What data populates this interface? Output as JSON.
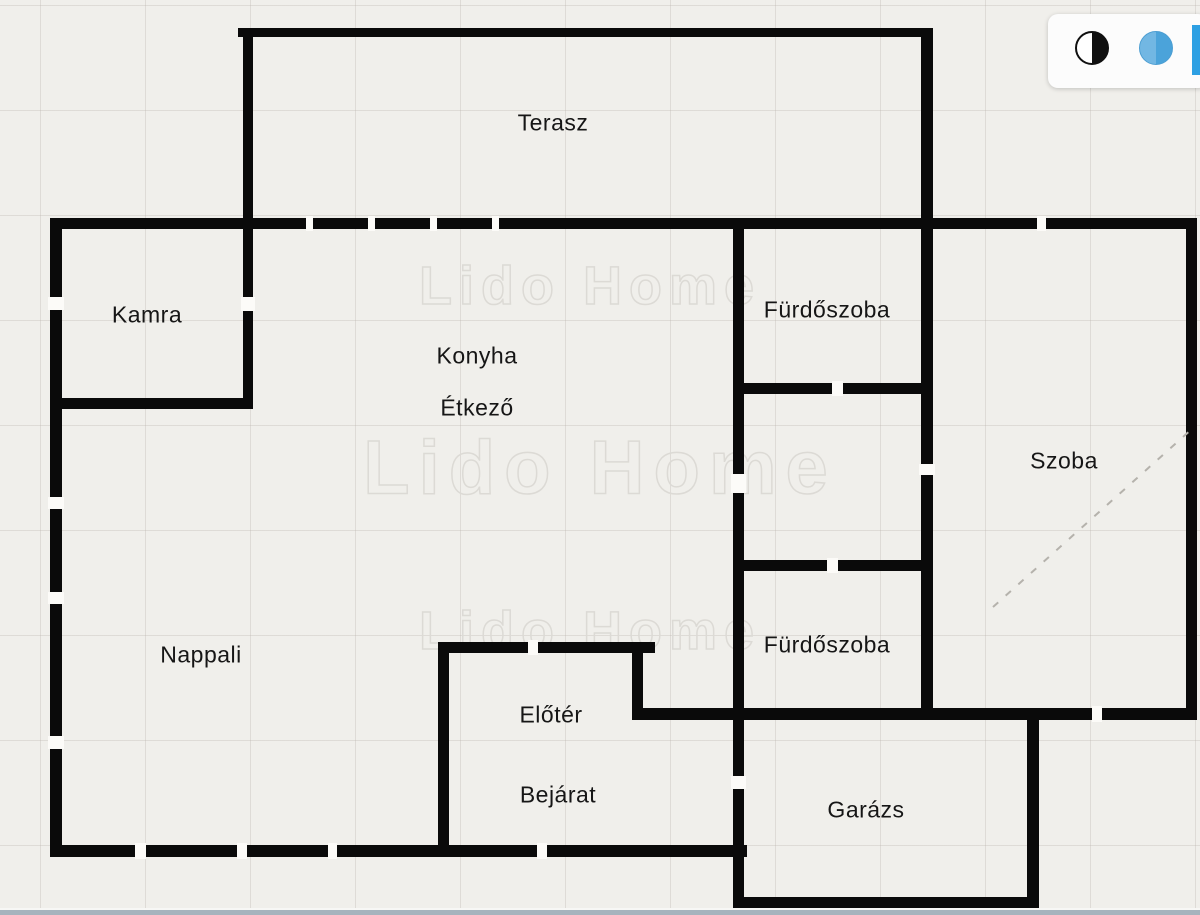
{
  "canvas": {
    "width": 1200,
    "height": 915,
    "background": "#f0efeb",
    "grid_color": "rgba(185,180,172,0.33)",
    "grid_size": 105
  },
  "watermark": {
    "text": "Lido Home",
    "outline_color": "#dcdad5",
    "instances": [
      {
        "x": 590,
        "y": 286,
        "font_size": 54,
        "letter_spacing": 7
      },
      {
        "x": 600,
        "y": 468,
        "font_size": 76,
        "letter_spacing": 9
      },
      {
        "x": 590,
        "y": 631,
        "font_size": 54,
        "letter_spacing": 7
      }
    ]
  },
  "floorplan": {
    "wall_color": "#0a0a0a",
    "opening_color": "#fcfbf8",
    "label_color": "#161616",
    "label_font_size": 23,
    "rooms": [
      {
        "id": "terasz",
        "label": "Terasz",
        "x": 553,
        "y": 123
      },
      {
        "id": "kamra",
        "label": "Kamra",
        "x": 147,
        "y": 315
      },
      {
        "id": "konyha",
        "label": "Konyha",
        "x": 477,
        "y": 356
      },
      {
        "id": "etkezo",
        "label": "Étkező",
        "x": 477,
        "y": 408
      },
      {
        "id": "furdoszoba-1",
        "label": "Fürdőszoba",
        "x": 827,
        "y": 310
      },
      {
        "id": "szoba",
        "label": "Szoba",
        "x": 1064,
        "y": 461
      },
      {
        "id": "nappali",
        "label": "Nappali",
        "x": 201,
        "y": 655
      },
      {
        "id": "furdoszoba-2",
        "label": "Fürdőszoba",
        "x": 827,
        "y": 645
      },
      {
        "id": "eloter",
        "label": "Előtér",
        "x": 551,
        "y": 715
      },
      {
        "id": "bejarat",
        "label": "Bejárat",
        "x": 558,
        "y": 795
      },
      {
        "id": "garazs",
        "label": "Garázs",
        "x": 866,
        "y": 810
      }
    ],
    "walls": [
      {
        "x": 50,
        "y": 218,
        "w": 12,
        "h": 639
      },
      {
        "x": 50,
        "y": 218,
        "w": 1147,
        "h": 11
      },
      {
        "x": 1186,
        "y": 218,
        "w": 11,
        "h": 502
      },
      {
        "x": 50,
        "y": 845,
        "w": 697,
        "h": 12
      },
      {
        "x": 632,
        "y": 708,
        "w": 565,
        "h": 12
      },
      {
        "x": 238,
        "y": 28,
        "w": 692,
        "h": 9
      },
      {
        "x": 243,
        "y": 28,
        "w": 10,
        "h": 380
      },
      {
        "x": 921,
        "y": 28,
        "w": 12,
        "h": 692
      },
      {
        "x": 50,
        "y": 398,
        "w": 203,
        "h": 11
      },
      {
        "x": 733,
        "y": 218,
        "w": 11,
        "h": 690
      },
      {
        "x": 733,
        "y": 383,
        "w": 200,
        "h": 11
      },
      {
        "x": 733,
        "y": 560,
        "w": 200,
        "h": 11
      },
      {
        "x": 438,
        "y": 642,
        "w": 11,
        "h": 215
      },
      {
        "x": 438,
        "y": 642,
        "w": 217,
        "h": 11
      },
      {
        "x": 632,
        "y": 642,
        "w": 11,
        "h": 78
      },
      {
        "x": 1027,
        "y": 708,
        "w": 12,
        "h": 200
      },
      {
        "x": 733,
        "y": 897,
        "w": 306,
        "h": 11
      }
    ],
    "openings": [
      {
        "x": 48,
        "y": 297,
        "w": 16,
        "h": 13
      },
      {
        "x": 48,
        "y": 497,
        "w": 16,
        "h": 12
      },
      {
        "x": 48,
        "y": 592,
        "w": 16,
        "h": 12
      },
      {
        "x": 48,
        "y": 736,
        "w": 16,
        "h": 13
      },
      {
        "x": 241,
        "y": 297,
        "w": 14,
        "h": 14
      },
      {
        "x": 306,
        "y": 216,
        "w": 7,
        "h": 15
      },
      {
        "x": 368,
        "y": 216,
        "w": 7,
        "h": 15
      },
      {
        "x": 430,
        "y": 216,
        "w": 7,
        "h": 15
      },
      {
        "x": 492,
        "y": 216,
        "w": 7,
        "h": 15
      },
      {
        "x": 1037,
        "y": 216,
        "w": 9,
        "h": 15
      },
      {
        "x": 919,
        "y": 464,
        "w": 16,
        "h": 11
      },
      {
        "x": 731,
        "y": 474,
        "w": 15,
        "h": 19
      },
      {
        "x": 731,
        "y": 776,
        "w": 15,
        "h": 13
      },
      {
        "x": 832,
        "y": 381,
        "w": 11,
        "h": 15
      },
      {
        "x": 827,
        "y": 558,
        "w": 11,
        "h": 15
      },
      {
        "x": 528,
        "y": 640,
        "w": 10,
        "h": 15
      },
      {
        "x": 135,
        "y": 843,
        "w": 11,
        "h": 16
      },
      {
        "x": 237,
        "y": 843,
        "w": 10,
        "h": 16
      },
      {
        "x": 328,
        "y": 843,
        "w": 9,
        "h": 16
      },
      {
        "x": 537,
        "y": 843,
        "w": 10,
        "h": 16
      },
      {
        "x": 1092,
        "y": 706,
        "w": 10,
        "h": 16
      }
    ],
    "dashed_line": {
      "x1": 993,
      "y1": 607,
      "x2": 1193,
      "y2": 428,
      "color": "#b5b2ac"
    }
  },
  "toolbar": {
    "background": "#fcfcfc",
    "icons": [
      {
        "name": "contrast-icon"
      },
      {
        "name": "blue-circle-icon",
        "color": "#4ba3da"
      }
    ],
    "edge_bar_color": "#2da0e3"
  },
  "bottom_strip_color": "#a6b3bd"
}
